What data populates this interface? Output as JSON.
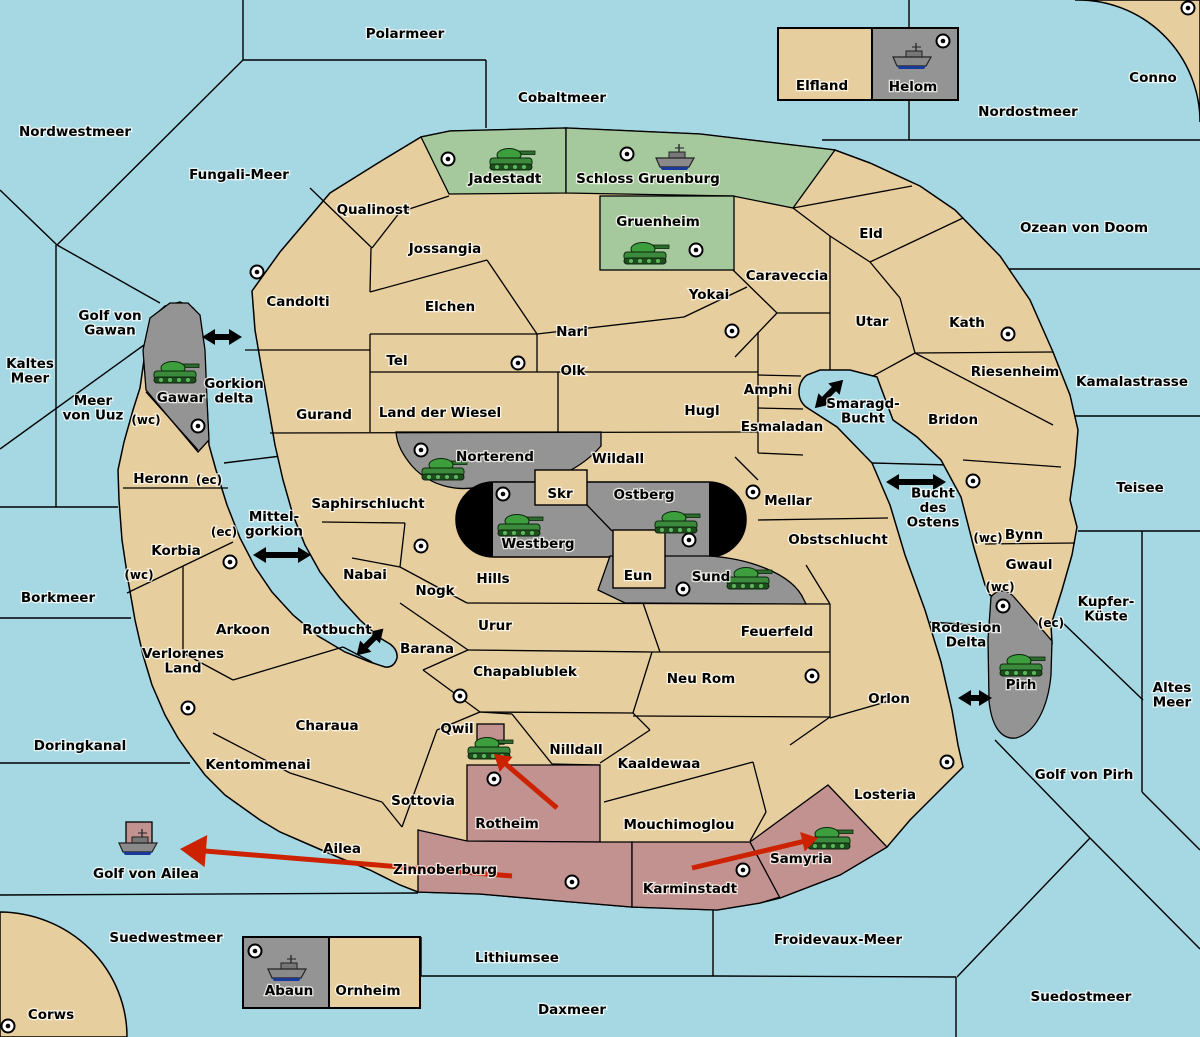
{
  "map_title": "Diplomacy-style strategy game map",
  "colors": {
    "water": "#a6d8e4",
    "land": "#e7ce9e",
    "green_region": "#a5c89d",
    "gray_region": "#949494",
    "red_region": "#c29290",
    "black_region": "#000000",
    "border": "#000000",
    "move_arrow": "#cc2200",
    "strait_arrow": "#000000",
    "tank": "#3c9e3c",
    "ship": "#8a8a8a"
  },
  "labels": [
    {
      "t": "Polarmeer",
      "x": 405,
      "y": 33,
      "kind": "sea"
    },
    {
      "t": "Cobaltmeer",
      "x": 562,
      "y": 97,
      "kind": "sea"
    },
    {
      "t": "Nordwestmeer",
      "x": 75,
      "y": 131,
      "kind": "sea"
    },
    {
      "t": "Fungali-Meer",
      "x": 239,
      "y": 174,
      "kind": "sea"
    },
    {
      "t": "Nordostmeer",
      "x": 1028,
      "y": 111,
      "kind": "sea"
    },
    {
      "t": "Conno",
      "x": 1153,
      "y": 77,
      "kind": "land"
    },
    {
      "t": "Ozean von Doom",
      "x": 1084,
      "y": 227,
      "kind": "sea"
    },
    {
      "t": "Elfland",
      "x": 822,
      "y": 85,
      "kind": "land"
    },
    {
      "t": "Helom",
      "x": 913,
      "y": 86,
      "kind": "land"
    },
    {
      "t": "Jadestadt",
      "x": 505,
      "y": 178,
      "kind": "land"
    },
    {
      "t": "Schloss Gruenburg",
      "x": 648,
      "y": 178,
      "kind": "land"
    },
    {
      "t": "Gruenheim",
      "x": 658,
      "y": 221,
      "kind": "land"
    },
    {
      "t": "Qualinost",
      "x": 373,
      "y": 209,
      "kind": "land"
    },
    {
      "t": "Jossangia",
      "x": 445,
      "y": 248,
      "kind": "land"
    },
    {
      "t": "Eld",
      "x": 871,
      "y": 233,
      "kind": "land"
    },
    {
      "t": "Caraveccia",
      "x": 787,
      "y": 275,
      "kind": "land"
    },
    {
      "t": "Yokai",
      "x": 709,
      "y": 294,
      "kind": "land"
    },
    {
      "t": "Candolti",
      "x": 298,
      "y": 301,
      "kind": "land"
    },
    {
      "t": "Elchen",
      "x": 450,
      "y": 306,
      "kind": "land"
    },
    {
      "t": "Nari",
      "x": 572,
      "y": 331,
      "kind": "land"
    },
    {
      "t": "Kath",
      "x": 967,
      "y": 322,
      "kind": "land"
    },
    {
      "t": "Utar",
      "x": 872,
      "y": 321,
      "kind": "land"
    },
    {
      "t": "Golf von\nGawan",
      "x": 110,
      "y": 322,
      "kind": "sea"
    },
    {
      "t": "Kaltes\nMeer",
      "x": 30,
      "y": 370,
      "kind": "sea"
    },
    {
      "t": "Tel",
      "x": 397,
      "y": 360,
      "kind": "land"
    },
    {
      "t": "Olk",
      "x": 573,
      "y": 370,
      "kind": "land"
    },
    {
      "t": "Riesenheim",
      "x": 1015,
      "y": 371,
      "kind": "land"
    },
    {
      "t": "Kamalastrasse",
      "x": 1132,
      "y": 381,
      "kind": "sea"
    },
    {
      "t": "Meer\nvon Uuz",
      "x": 93,
      "y": 407,
      "kind": "sea"
    },
    {
      "t": "Gawar",
      "x": 181,
      "y": 397,
      "kind": "land"
    },
    {
      "t": "Gorkion\ndelta",
      "x": 234,
      "y": 390,
      "kind": "sea"
    },
    {
      "t": "Amphi",
      "x": 768,
      "y": 389,
      "kind": "land"
    },
    {
      "t": "Smaragd-\nBucht",
      "x": 863,
      "y": 410,
      "kind": "sea"
    },
    {
      "t": "Land der Wiesel",
      "x": 440,
      "y": 412,
      "kind": "land"
    },
    {
      "t": "Hugl",
      "x": 702,
      "y": 410,
      "kind": "land"
    },
    {
      "t": "Gurand",
      "x": 324,
      "y": 414,
      "kind": "land"
    },
    {
      "t": "Esmaladan",
      "x": 782,
      "y": 426,
      "kind": "land"
    },
    {
      "t": "Bridon",
      "x": 953,
      "y": 419,
      "kind": "land"
    },
    {
      "t": "(wc)",
      "x": 146,
      "y": 419,
      "kind": "coast"
    },
    {
      "t": "Heronn",
      "x": 161,
      "y": 478,
      "kind": "land"
    },
    {
      "t": "(ec)",
      "x": 209,
      "y": 479,
      "kind": "coast"
    },
    {
      "t": "Norterend",
      "x": 495,
      "y": 456,
      "kind": "land"
    },
    {
      "t": "Wildall",
      "x": 618,
      "y": 458,
      "kind": "land"
    },
    {
      "t": "Skr",
      "x": 560,
      "y": 493,
      "kind": "land"
    },
    {
      "t": "Ostberg",
      "x": 644,
      "y": 494,
      "kind": "land"
    },
    {
      "t": "Mellar",
      "x": 788,
      "y": 500,
      "kind": "land"
    },
    {
      "t": "Saphirschlucht",
      "x": 368,
      "y": 503,
      "kind": "land"
    },
    {
      "t": "Bucht\ndes\nOstens",
      "x": 933,
      "y": 507,
      "kind": "sea"
    },
    {
      "t": "Teisee",
      "x": 1140,
      "y": 487,
      "kind": "sea"
    },
    {
      "t": "(ec)",
      "x": 224,
      "y": 531,
      "kind": "coast"
    },
    {
      "t": "Mittel-\ngorkion",
      "x": 274,
      "y": 523,
      "kind": "sea"
    },
    {
      "t": "Westberg",
      "x": 538,
      "y": 543,
      "kind": "land"
    },
    {
      "t": "Obstschlucht",
      "x": 838,
      "y": 539,
      "kind": "land"
    },
    {
      "t": "Bynn",
      "x": 1024,
      "y": 534,
      "kind": "land"
    },
    {
      "t": "(wc)",
      "x": 988,
      "y": 537,
      "kind": "coast"
    },
    {
      "t": "Korbia",
      "x": 176,
      "y": 550,
      "kind": "land"
    },
    {
      "t": "(wc)",
      "x": 139,
      "y": 574,
      "kind": "coast"
    },
    {
      "t": "Gwaul",
      "x": 1029,
      "y": 564,
      "kind": "land"
    },
    {
      "t": "Borkmeer",
      "x": 58,
      "y": 597,
      "kind": "sea"
    },
    {
      "t": "Nabai",
      "x": 365,
      "y": 574,
      "kind": "land"
    },
    {
      "t": "Eun",
      "x": 638,
      "y": 575,
      "kind": "land"
    },
    {
      "t": "Sund",
      "x": 711,
      "y": 576,
      "kind": "land"
    },
    {
      "t": "Hills",
      "x": 493,
      "y": 578,
      "kind": "land"
    },
    {
      "t": "Nogk",
      "x": 435,
      "y": 590,
      "kind": "land"
    },
    {
      "t": "(wc)",
      "x": 1000,
      "y": 586,
      "kind": "coast"
    },
    {
      "t": "Kupfer-\nKüste",
      "x": 1106,
      "y": 608,
      "kind": "sea"
    },
    {
      "t": "(ec)",
      "x": 1051,
      "y": 622,
      "kind": "coast"
    },
    {
      "t": "Urur",
      "x": 495,
      "y": 625,
      "kind": "land"
    },
    {
      "t": "Arkoon",
      "x": 243,
      "y": 629,
      "kind": "land"
    },
    {
      "t": "Rotbucht",
      "x": 337,
      "y": 629,
      "kind": "sea"
    },
    {
      "t": "Feuerfeld",
      "x": 777,
      "y": 631,
      "kind": "land"
    },
    {
      "t": "Barana",
      "x": 427,
      "y": 648,
      "kind": "land"
    },
    {
      "t": "Rodesion\nDelta",
      "x": 966,
      "y": 634,
      "kind": "sea"
    },
    {
      "t": "Chapablublek",
      "x": 525,
      "y": 671,
      "kind": "land"
    },
    {
      "t": "Neu Rom",
      "x": 701,
      "y": 678,
      "kind": "land"
    },
    {
      "t": "Verlorenes\nLand",
      "x": 183,
      "y": 660,
      "kind": "land"
    },
    {
      "t": "Pirh",
      "x": 1021,
      "y": 684,
      "kind": "land"
    },
    {
      "t": "Orlon",
      "x": 889,
      "y": 698,
      "kind": "land"
    },
    {
      "t": "Altes\nMeer",
      "x": 1172,
      "y": 694,
      "kind": "sea"
    },
    {
      "t": "Charaua",
      "x": 327,
      "y": 725,
      "kind": "land"
    },
    {
      "t": "Doringkanal",
      "x": 80,
      "y": 745,
      "kind": "sea"
    },
    {
      "t": "Qwil",
      "x": 457,
      "y": 728,
      "kind": "land"
    },
    {
      "t": "Nilldall",
      "x": 576,
      "y": 749,
      "kind": "land"
    },
    {
      "t": "Kaaldewaa",
      "x": 659,
      "y": 763,
      "kind": "land"
    },
    {
      "t": "Kentommenai",
      "x": 258,
      "y": 764,
      "kind": "land"
    },
    {
      "t": "Golf von Pirh",
      "x": 1084,
      "y": 774,
      "kind": "sea"
    },
    {
      "t": "Losteria",
      "x": 885,
      "y": 794,
      "kind": "land"
    },
    {
      "t": "Sottovia",
      "x": 423,
      "y": 800,
      "kind": "land"
    },
    {
      "t": "Rotheim",
      "x": 507,
      "y": 823,
      "kind": "land"
    },
    {
      "t": "Mouchimoglou",
      "x": 679,
      "y": 824,
      "kind": "land"
    },
    {
      "t": "Ailea",
      "x": 342,
      "y": 848,
      "kind": "land"
    },
    {
      "t": "Samyria",
      "x": 801,
      "y": 858,
      "kind": "land"
    },
    {
      "t": "Golf von Ailea",
      "x": 146,
      "y": 873,
      "kind": "sea"
    },
    {
      "t": "Zinnoberburg",
      "x": 445,
      "y": 869,
      "kind": "land"
    },
    {
      "t": "Karminstadt",
      "x": 690,
      "y": 888,
      "kind": "land"
    },
    {
      "t": "Suedwestmeer",
      "x": 166,
      "y": 937,
      "kind": "sea"
    },
    {
      "t": "Froidevaux-Meer",
      "x": 838,
      "y": 939,
      "kind": "sea"
    },
    {
      "t": "Lithiumsee",
      "x": 517,
      "y": 957,
      "kind": "sea"
    },
    {
      "t": "Abaun",
      "x": 289,
      "y": 990,
      "kind": "land"
    },
    {
      "t": "Ornheim",
      "x": 368,
      "y": 990,
      "kind": "land"
    },
    {
      "t": "Corws",
      "x": 51,
      "y": 1014,
      "kind": "land"
    },
    {
      "t": "Daxmeer",
      "x": 572,
      "y": 1009,
      "kind": "sea"
    },
    {
      "t": "Suedostmeer",
      "x": 1081,
      "y": 996,
      "kind": "sea"
    },
    {
      "t": "Golf von Pirh",
      "x": 1084,
      "y": 774,
      "kind": "sea-skip"
    }
  ],
  "supply_centers": [
    [
      448,
      159
    ],
    [
      627,
      154
    ],
    [
      696,
      250
    ],
    [
      257,
      272
    ],
    [
      1188,
      8
    ],
    [
      943,
      41
    ],
    [
      732,
      331
    ],
    [
      1008,
      334
    ],
    [
      518,
      363
    ],
    [
      198,
      426
    ],
    [
      421,
      450
    ],
    [
      421,
      546
    ],
    [
      503,
      494
    ],
    [
      753,
      492
    ],
    [
      689,
      540
    ],
    [
      683,
      589
    ],
    [
      230,
      562
    ],
    [
      973,
      481
    ],
    [
      1003,
      606
    ],
    [
      812,
      676
    ],
    [
      460,
      696
    ],
    [
      188,
      708
    ],
    [
      494,
      779
    ],
    [
      572,
      882
    ],
    [
      743,
      870
    ],
    [
      947,
      762
    ],
    [
      8,
      1026
    ],
    [
      255,
      951
    ]
  ],
  "units": {
    "tanks": [
      {
        "region": "Jadestadt",
        "x": 511,
        "y": 160
      },
      {
        "region": "Gruenheim",
        "x": 645,
        "y": 254
      },
      {
        "region": "Gawar",
        "x": 175,
        "y": 373
      },
      {
        "region": "Norterend",
        "x": 443,
        "y": 470
      },
      {
        "region": "Westberg",
        "x": 519,
        "y": 526
      },
      {
        "region": "Ostberg",
        "x": 676,
        "y": 523
      },
      {
        "region": "Sund",
        "x": 748,
        "y": 579
      },
      {
        "region": "Qwil",
        "x": 489,
        "y": 749
      },
      {
        "region": "Samyria",
        "x": 829,
        "y": 839
      },
      {
        "region": "Pirh",
        "x": 1021,
        "y": 666
      }
    ],
    "ships": [
      {
        "region": "Schloss Gruenburg",
        "x": 676,
        "y": 160
      },
      {
        "region": "Helom",
        "x": 913,
        "y": 59
      },
      {
        "region": "Abaun",
        "x": 288,
        "y": 971
      },
      {
        "region": "Golf von Ailea",
        "x": 139,
        "y": 845
      }
    ]
  },
  "dislodged_markers": [
    {
      "x": 477,
      "y": 724,
      "w": 27,
      "h": 20
    },
    {
      "x": 126,
      "y": 822,
      "w": 26,
      "h": 22
    }
  ],
  "move_arrows": [
    {
      "x1": 557,
      "y1": 808,
      "x2": 494,
      "y2": 754,
      "head": 16
    },
    {
      "x1": 692,
      "y1": 868,
      "x2": 818,
      "y2": 838,
      "head": 16
    },
    {
      "x1": 512,
      "y1": 876,
      "x2": 180,
      "y2": 849,
      "head": 26
    }
  ],
  "strait_arrows": [
    {
      "x": 222,
      "y": 337,
      "angle": 0,
      "len": 40
    },
    {
      "x": 829,
      "y": 394,
      "angle": -45,
      "len": 40
    },
    {
      "x": 916,
      "y": 482,
      "angle": 0,
      "len": 60
    },
    {
      "x": 282,
      "y": 555,
      "angle": 0,
      "len": 58
    },
    {
      "x": 370,
      "y": 642,
      "angle": -45,
      "len": 38
    },
    {
      "x": 975,
      "y": 698,
      "angle": 0,
      "len": 34
    }
  ]
}
